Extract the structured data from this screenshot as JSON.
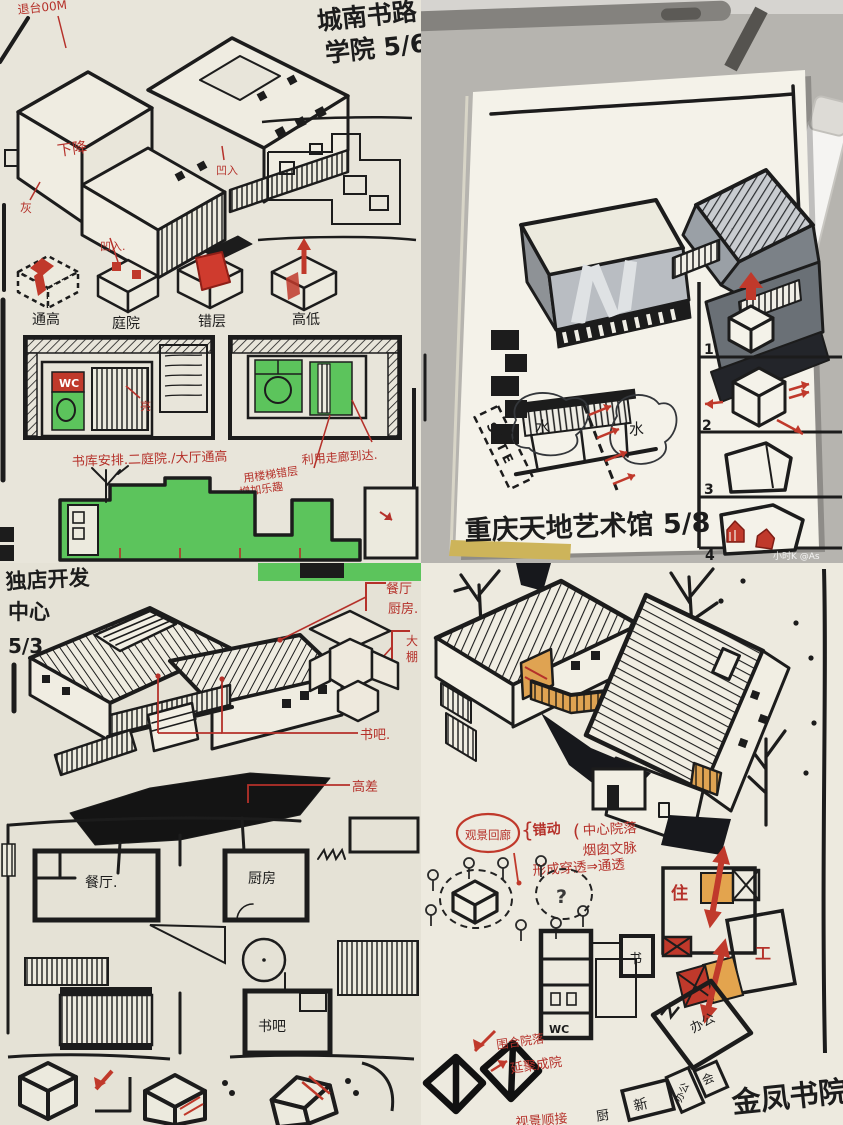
{
  "watermark": "小时K @As",
  "top_left": {
    "title1": "城南书路",
    "title2": "学院 5/6",
    "corner_note": "退台00M",
    "descend": "下降",
    "recess_a": "凹入",
    "recess_b": "凹入.",
    "gray": "灰",
    "bright": "亮",
    "wc": "WC",
    "concepts": [
      "通高",
      "庭院",
      "错层",
      "高低"
    ],
    "strategy": "书库安排.二庭院./大厅通高",
    "stair1": "用楼梯错层",
    "stair2": "增加乐趣",
    "corridor": "利用走廊到达."
  },
  "top_right": {
    "water1": "水",
    "water2": "水",
    "site": "SITE",
    "steps": [
      "1",
      "2",
      "3",
      "4"
    ],
    "title": "重庆天地艺术馆 5/8"
  },
  "bottom_left": {
    "title1": "独店开发",
    "title2": "中心",
    "title3": "5/3",
    "dining_note": "餐厅",
    "kitchen_note": "厨房.",
    "shed1": "大",
    "shed2": "棚",
    "bookbar_note": "书吧.",
    "height_note": "高差",
    "plan_dining": "餐厅.",
    "plan_kitchen": "厨房",
    "plan_bookbar": "书吧"
  },
  "bottom_right": {
    "view_gallery": "观景回廊",
    "brace": "{",
    "paren": "(",
    "shift": "错动",
    "courtyard_center": "中心院落",
    "chimney": "烟囱文脉",
    "through": "形成穿透⇒通透",
    "question": "?",
    "live": "住",
    "work": "工",
    "plan_book": "书",
    "plan_wc": "WC",
    "plan_office": "办公",
    "plan_kitchen": "厨",
    "plan_new": "新",
    "plan_office2": "办公",
    "plan_meeting": "会",
    "enclosed": "围合院落",
    "extend": "延聚成院",
    "view_seq": "视景顺接",
    "title": "金凤书院"
  }
}
